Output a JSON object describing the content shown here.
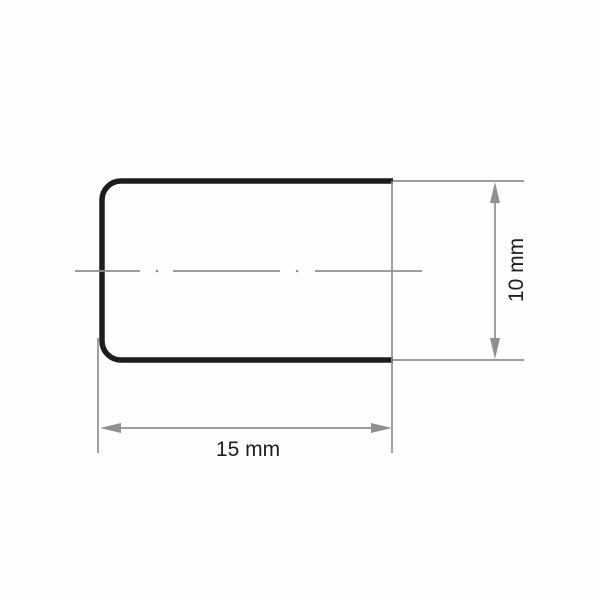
{
  "drawing": {
    "type": "technical-dimension-drawing",
    "shape": "rounded-left rectangle profile, open right end",
    "width_label": "15 mm",
    "height_label": "10 mm"
  },
  "colors": {
    "outline": "#1d1d1b",
    "dimension_gray": "#8f8f8f",
    "label_text": "#1d1d1b",
    "background": "#ffffff"
  }
}
